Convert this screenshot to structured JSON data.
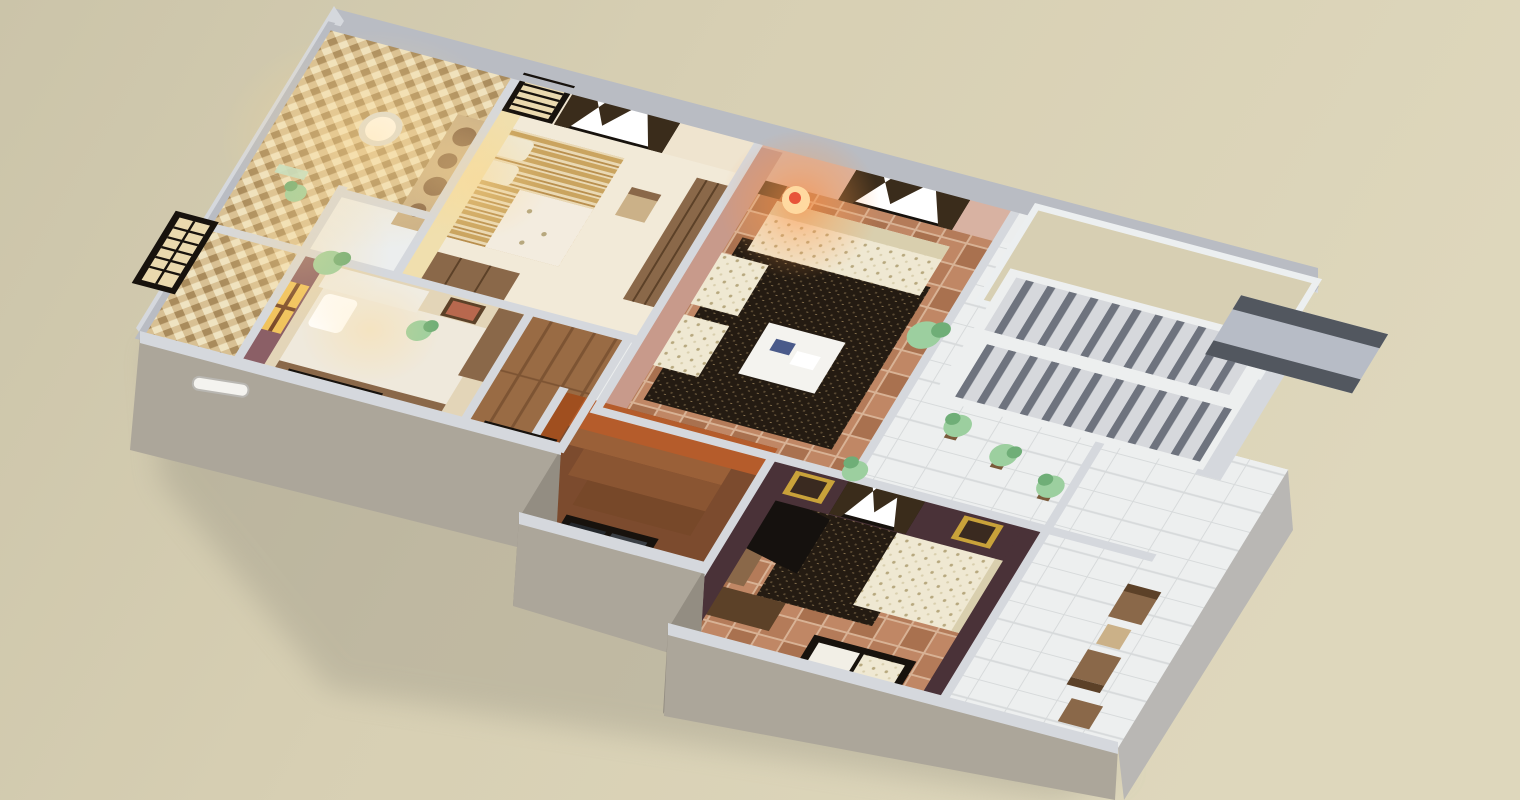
{
  "scene": {
    "type": "3d-floorplan-dollhouse-render",
    "view": "isometric-cutaway-top-down",
    "floors_shown": 1,
    "rooms": [
      {
        "name": "bathroom",
        "items": [
          "mosaic-tile-walls",
          "ceiling-spot-lights",
          "round-basin",
          "wall-niche",
          "glass-shelf"
        ]
      },
      {
        "name": "bedroom-top",
        "items": [
          "striped-double-bed",
          "lace-throw",
          "log-slice-headboard-panel",
          "chair",
          "wardrobe",
          "dresser",
          "curtained-window",
          "shoji-window"
        ]
      },
      {
        "name": "living-room",
        "items": [
          "cream-floral-sofa",
          "two-cream-armchairs",
          "dark-speckled-rug",
          "white-coffee-table",
          "glowing-table-lamp",
          "curtained-window",
          "potted-plant",
          "terracotta-tile-floor"
        ]
      },
      {
        "name": "stair-hall",
        "items": [
          "double-flight-staircase",
          "protruding-landing-platform",
          "three-potted-plants",
          "open-void-to-below",
          "white-tile-floor"
        ]
      },
      {
        "name": "bedroom-front-left",
        "items": [
          "double-bed",
          "vanity-dresser",
          "gold-lit-window",
          "wall-picture",
          "potted-plants",
          "protruding-front-windows"
        ]
      },
      {
        "name": "corridor",
        "items": [
          "wood-plank-floor",
          "front-shoji-door"
        ]
      },
      {
        "name": "stairwell-down",
        "items": [
          "orange-walls",
          "descending-steps",
          "front-window"
        ]
      },
      {
        "name": "tv-lounge",
        "items": [
          "cream-floral-sofa",
          "dark-speckled-rug",
          "tv-on-wood-console",
          "gold-picture-frames",
          "dark-curtains",
          "front-cushioned-bench",
          "potted-plant"
        ]
      },
      {
        "name": "patio-walkway",
        "items": [
          "white-tile-deck",
          "two-wood-chairs",
          "small-wood-table",
          "wood-stool"
        ]
      }
    ],
    "exterior": [
      "gray-outer-shell-walls",
      "cut-wall-caps",
      "protruding-window-boxes",
      "wall-vent-slot",
      "soft-ground-shadow"
    ]
  },
  "colors": {
    "bg": "#d7cfb3",
    "bgLight": "#ded7bc",
    "bgShadow": "#8e8a7b",
    "wallCap": "#b9bcc3",
    "wallCapLight": "#d5d8dd",
    "wallOuterNW": "#a4a3a9",
    "wallOuterFront": "#aca69a",
    "wallOuterFrontDark": "#938d82",
    "wallOuterEast": "#b9b7b4",
    "wallInnerCream": "#efe4cf",
    "wallPink": "#d8b2a2",
    "wallPinkDeep": "#c89a8b",
    "wallMauve": "#8b5f66",
    "wallDark": "#4a3238",
    "wallOrange": "#b55c2b",
    "wallOrangeDeep": "#a04f1f",
    "wallWhite": "#eceeee",
    "floorCream": "#f2ead8",
    "floorTan": "#e3d5b8",
    "mosaicA": "#d8c093",
    "mosaicB": "#a98b5c",
    "mosaicC": "#efe3c1",
    "terraA": "#c08765",
    "terraB": "#a9714f",
    "terraGrout": "#d8b295",
    "rugBase": "#241b12",
    "rugFleck": "#5a4a33",
    "rugFleck2": "#8a7450",
    "tileWhite": "#edefef",
    "tileLine": "#d7dadb",
    "plankA": "#996b44",
    "plankB": "#7d5433",
    "sofaBase": "#efe8d2",
    "sofaFleck": "#b7a87e",
    "sofaShade": "#d9cfae",
    "tableWhite": "#f4f3ef",
    "woodMid": "#8a6849",
    "woodDark": "#5c4128",
    "woodLight": "#cbb188",
    "frameDark": "#17120d",
    "curtain": "#3a2c1b",
    "slatCream": "#ead9ae",
    "glassDark": "#24282d",
    "stairTread": "#d6d8dc",
    "stairRiser": "#6e737e",
    "landingTop": "#b7bcc6",
    "landingEdge": "#52575f",
    "gold": "#f0c35c",
    "goldFrame": "#c9a23a",
    "artRed": "#b8684e",
    "plantGreen": "#9ccf9f",
    "plantDark": "#6fae77",
    "potBrown": "#7a5a3a",
    "benchWhite": "#f2efe6",
    "tvBlack": "#15110e",
    "glowOrange": "#ff8c3c",
    "glowGold": "#ffd98e",
    "white": "#ffffff"
  }
}
